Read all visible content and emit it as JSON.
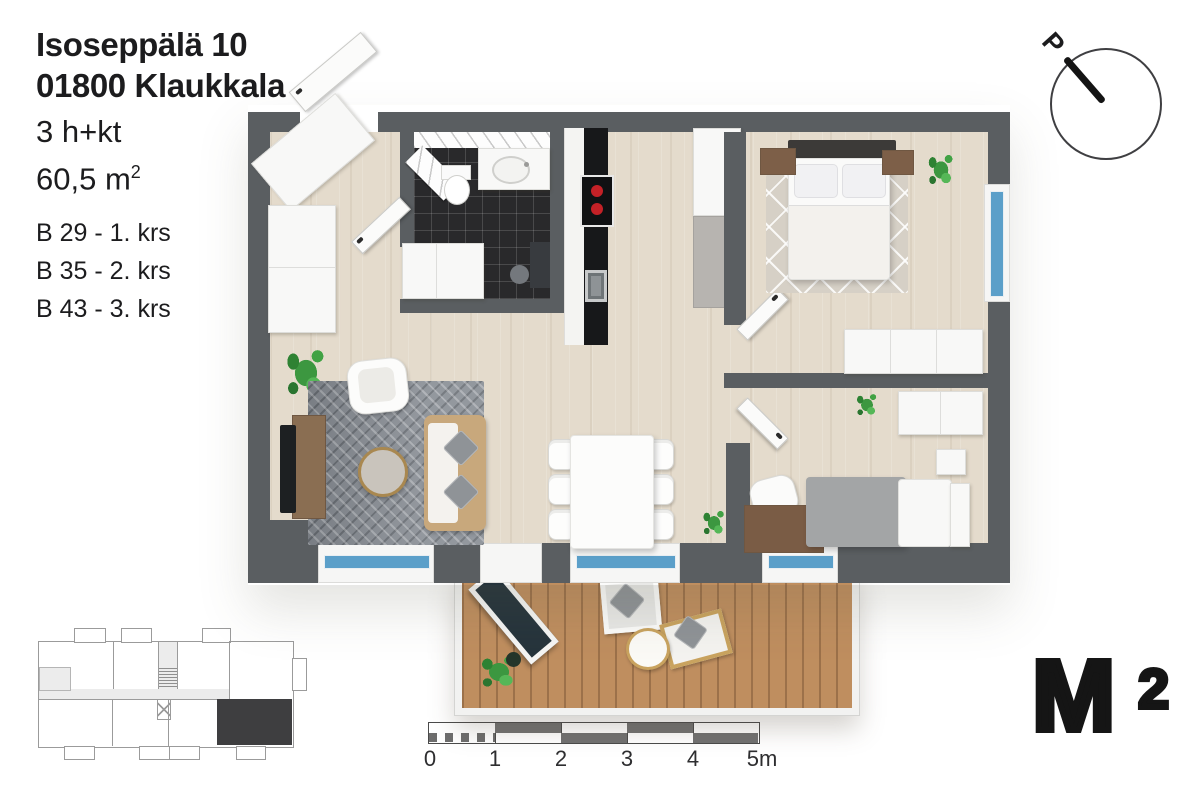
{
  "header": {
    "address_line1": "Isoseppälä 10",
    "address_line2": "01800 Klaukkala",
    "apartment_type": "3 h+kt",
    "area_value": "60,5 m",
    "area_sup": "2",
    "units": [
      {
        "label": "B 29 - 1. krs"
      },
      {
        "label": "B 35 - 2. krs"
      },
      {
        "label": "B 43 - 3. krs"
      }
    ]
  },
  "compass": {
    "north_label": "P"
  },
  "scale_bar": {
    "tick_labels": [
      "0",
      "1",
      "2",
      "3",
      "4",
      "5m"
    ]
  },
  "logo": {
    "letter": "M",
    "superscript": "2"
  },
  "colors": {
    "wall": "#5a5e61",
    "floor_wood": "#e4dbcc",
    "bathroom_tile": "#29292b",
    "balcony_deck": "#bf8e5f",
    "window_glass": "#5b9fc9",
    "living_rug": "#878c93",
    "highlight_unit": "#3e3e40",
    "stove_burner": "#c42127",
    "text": "#1c1c1e"
  }
}
